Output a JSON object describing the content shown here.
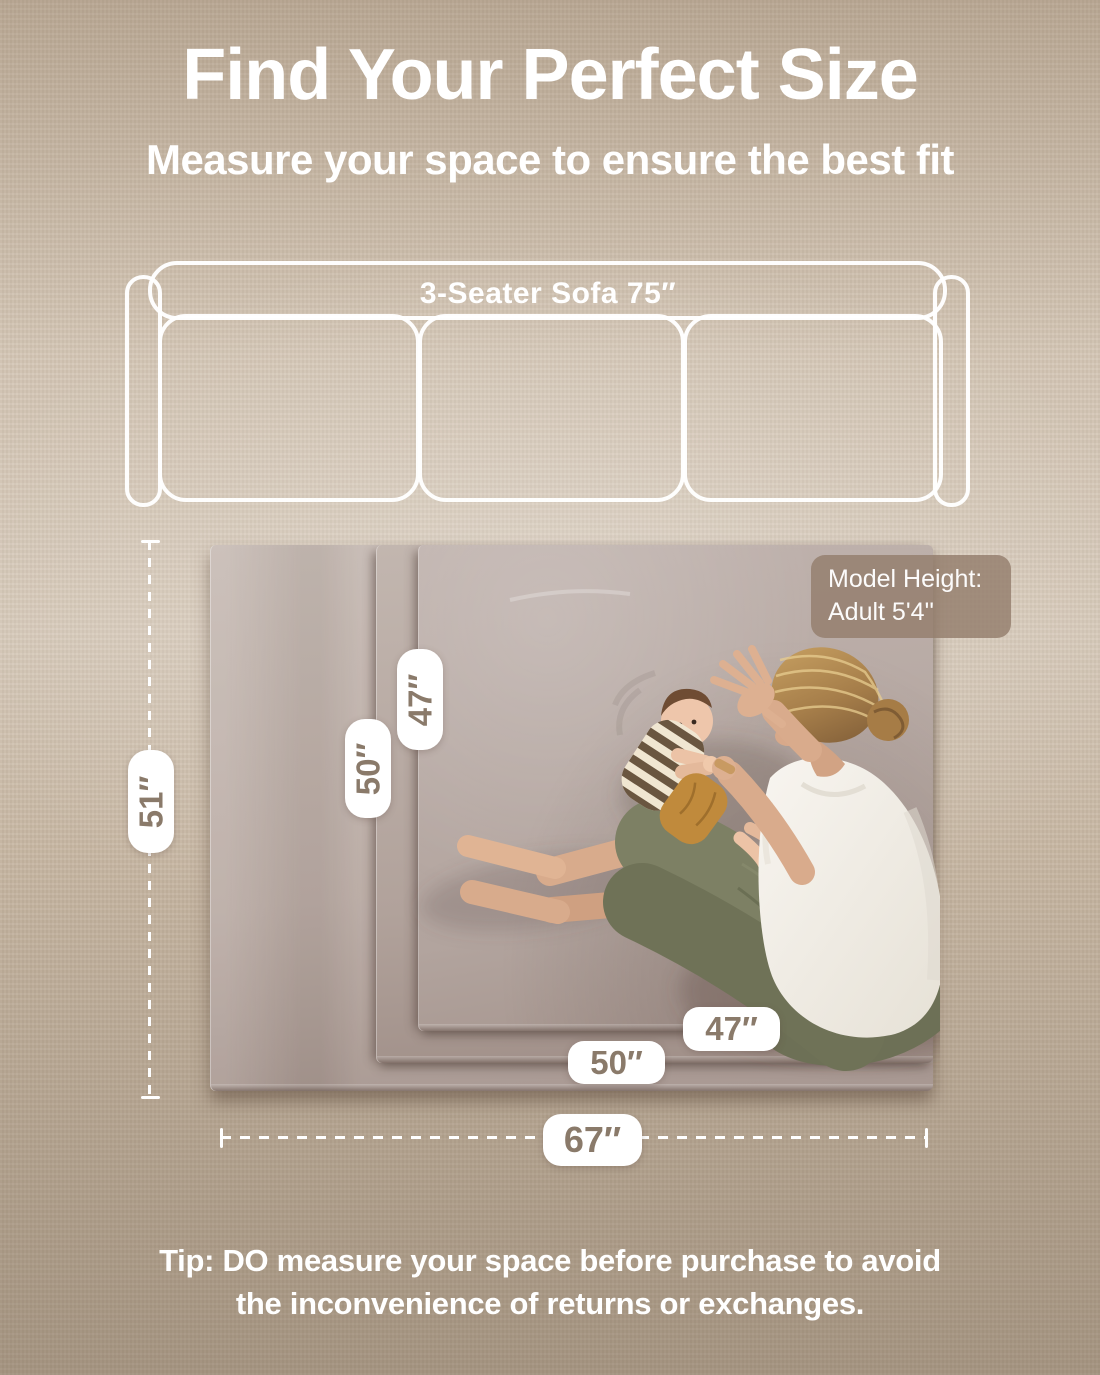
{
  "header": {
    "title": "Find Your Perfect Size",
    "subtitle": "Measure your space to ensure the best fit"
  },
  "sofa": {
    "label": "3-Seater Sofa 75″"
  },
  "mat": {
    "labels": {
      "side_large": "51″",
      "side_mid": "50″",
      "side_small": "47″",
      "bottom_small": "47″",
      "bottom_mid": "50″",
      "bottom_large": "67″"
    }
  },
  "model_badge": {
    "line1": "Model Height:",
    "line2": "Adult  5'4''"
  },
  "tip": {
    "line1": "Tip: DO measure your space before purchase to avoid",
    "line2": "the inconvenience of returns or exchanges."
  },
  "colors": {
    "carpet": "#cfc0ad",
    "carpet_dark": "#aa9883",
    "mat_surface": "#b8aba5",
    "pill_text": "#8a7a6a",
    "badge_bg": "rgba(148,126,108,0.82)",
    "dimension_line": "#ffffff",
    "title_text": "#ffffff"
  }
}
